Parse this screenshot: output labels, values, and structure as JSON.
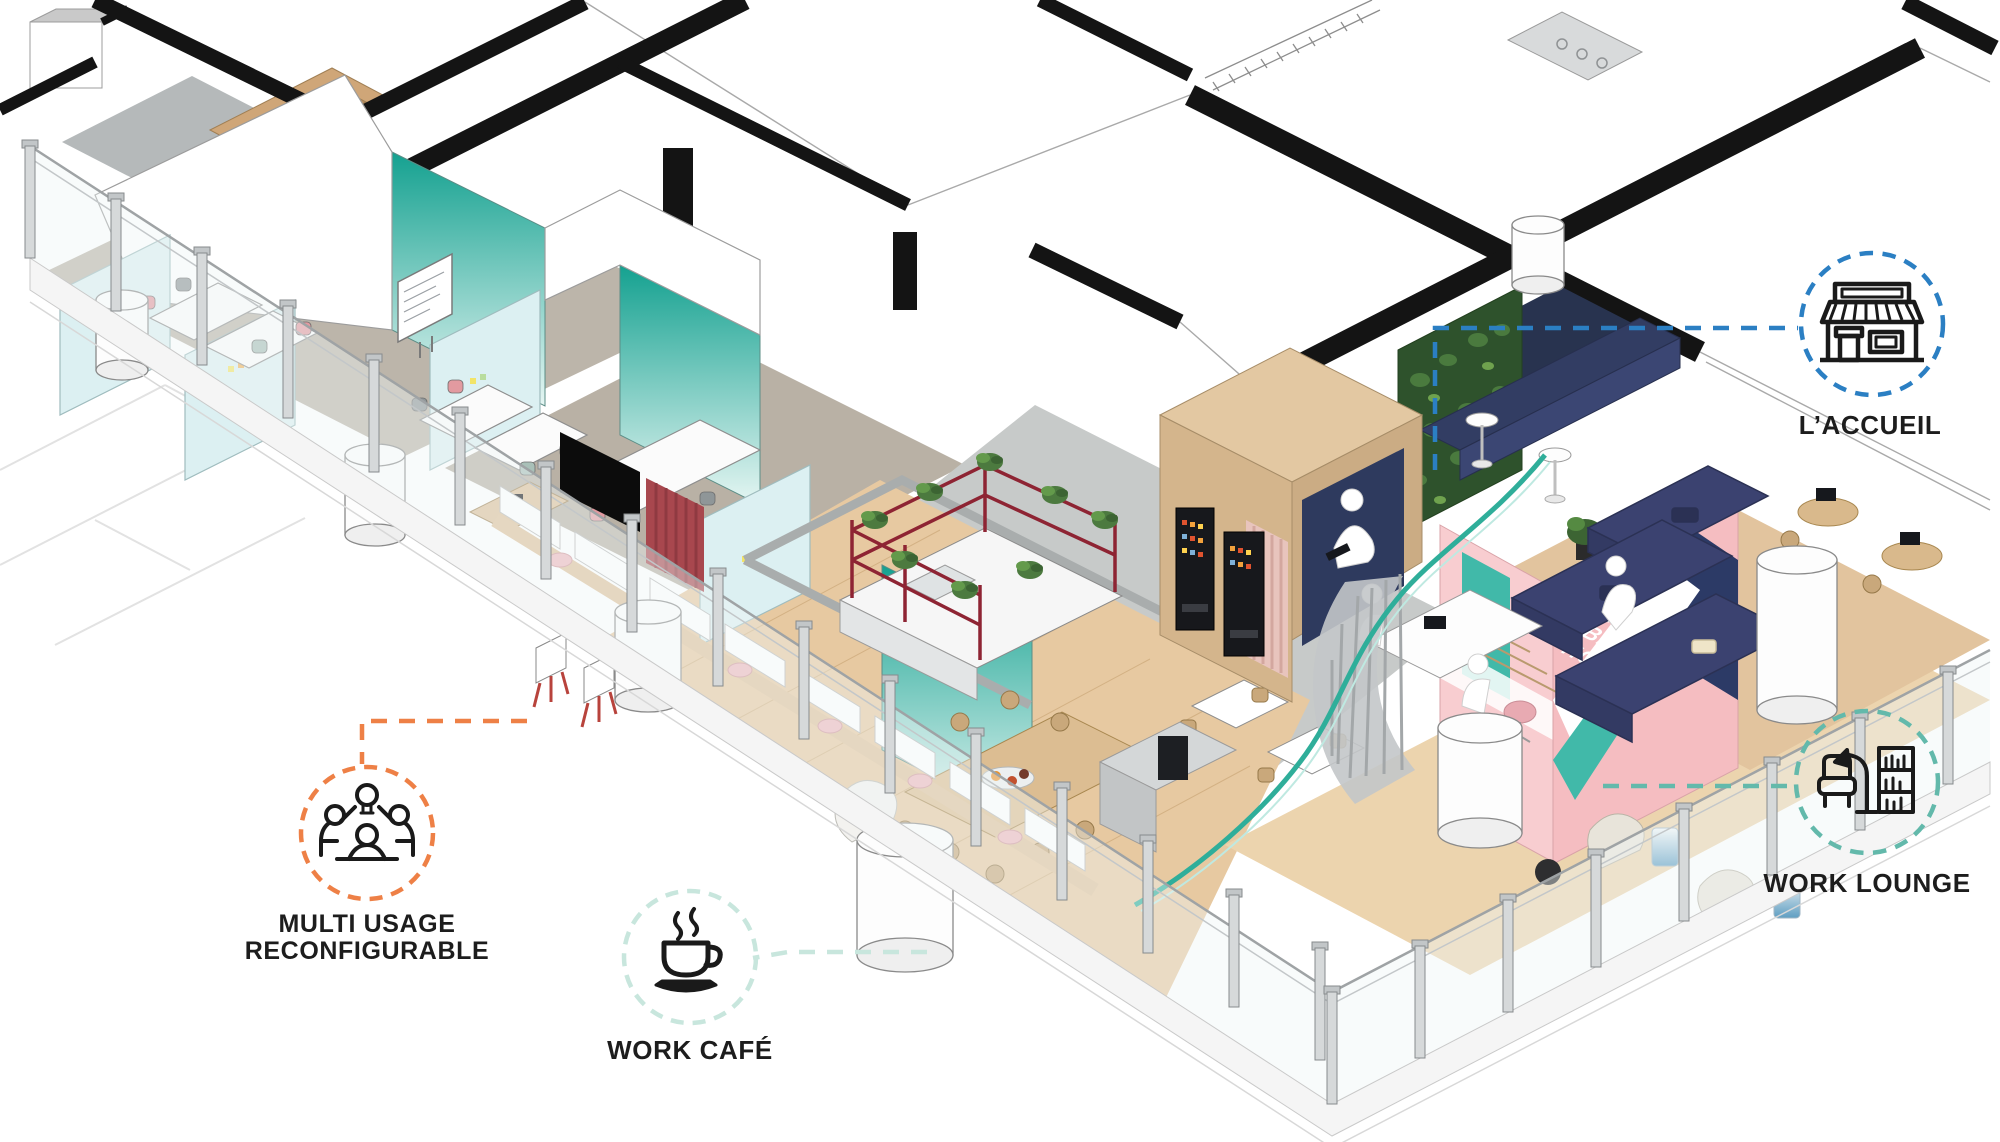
{
  "scene": {
    "background_color": "#ffffff",
    "mural": {
      "line1": "MAKING",
      "line2": "THE WORLD",
      "line3": "A BETTER",
      "line4": "HOME",
      "wall_color": "#f5bdc1"
    },
    "palette": {
      "cut_wall_black": "#141414",
      "teal_glass": "#17a392",
      "light_blue_glass": "#dcf0f2",
      "carpet": "#bcb5aa",
      "wood_floor": "#e7c9a1",
      "navy_sofa": "#3b4270",
      "green_wall": "#35582f",
      "red_shelf_frame": "#8e2433"
    }
  },
  "callouts": {
    "accueil": {
      "label": "L’ACCUEIL",
      "color": "#2b7fc3",
      "icon": "storefront-icon"
    },
    "work_lounge": {
      "label": "WORK LOUNGE",
      "color": "#63b9ab",
      "icon": "lounge-furniture-icon"
    },
    "multi_usage": {
      "label_line1": "MULTI USAGE",
      "label_line2": "RECONFIGURABLE",
      "color": "#ee8046",
      "icon": "collaboration-people-icon"
    },
    "work_cafe": {
      "label": "WORK CAFÉ",
      "color": "#c8e6dd",
      "icon": "coffee-cup-icon"
    }
  }
}
